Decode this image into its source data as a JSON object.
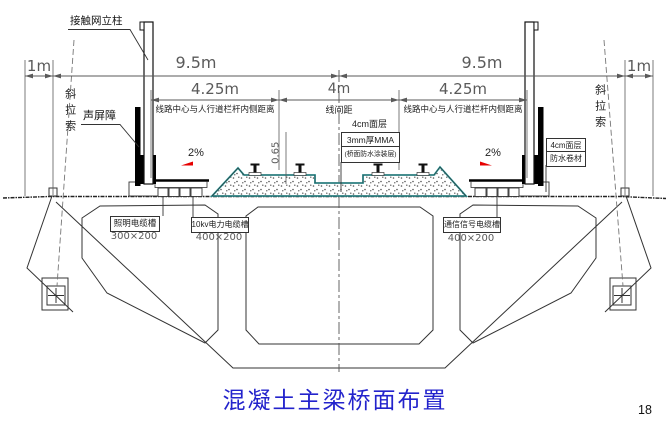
{
  "drawing": {
    "labels": {
      "catenary_pole": "接触网立柱",
      "sound_barrier": "声屏障",
      "stay_cable": "斜拉索",
      "slope_left": "2%",
      "slope_right": "2%"
    },
    "dimensions": {
      "edge_left": "1m",
      "half_left": "9.5m",
      "half_right": "9.5m",
      "edge_right": "1m",
      "offset_left": "4.25m",
      "track_spacing": "4m",
      "offset_right": "4.25m",
      "slab_height": "0.65",
      "offset_desc_left": "线路中心与人行道栏杆内侧距离",
      "spacing_desc": "线间距",
      "offset_desc_right": "线路中心与人行道栏杆内侧距离"
    },
    "deck_layers_center": {
      "surface": "4cm面层",
      "mma": "3mm厚MMA",
      "coating": "(桥面防水涂装层)"
    },
    "deck_layers_right": {
      "surface": "4cm面层",
      "membrane": "防水卷材"
    },
    "cable_troughs": {
      "lighting": {
        "name": "照明电缆槽",
        "size": "300×200"
      },
      "power": {
        "name": "10kv电力电缆槽",
        "size": "400×200"
      },
      "signal": {
        "name": "通信信号电缆槽",
        "size": "400×200"
      }
    }
  },
  "caption": {
    "title": "混凝土主梁桥面布置"
  },
  "page": {
    "number": "18"
  },
  "colors": {
    "title_blue": "#2323cc",
    "waterproof_teal": "#2a9d9f",
    "slope_red": "#e60000",
    "line_dark": "#333333",
    "dim_gray": "#5a5a5a"
  }
}
